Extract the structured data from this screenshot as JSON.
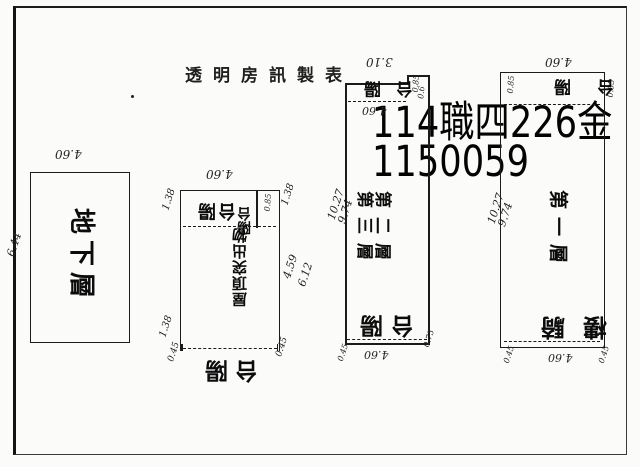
{
  "page": {
    "paper_color": "#fbfbf9",
    "ink_color": "#1b1b1b"
  },
  "header": {
    "title": "透明房訊製表"
  },
  "overlay": {
    "line1": "114職四226金",
    "line2": "1150059"
  },
  "plans": {
    "basement": {
      "label": "地下層",
      "dim_width": "4.60",
      "dim_height": "6.44"
    },
    "roof": {
      "dim_width": "4.60",
      "dim_corner_tl": "1.38",
      "dim_corner_tr": "1.38",
      "balcony_top": "陽台",
      "balcony_side": "陽台",
      "dim_inner": "0.85",
      "label": "屋頂突出物",
      "dim_side_a": "4.59",
      "dim_side_b": "6.12",
      "dim_corner_bl_a": "1.38",
      "dim_corner_bl_b": "0.45",
      "dim_corner_br": "0.45",
      "balcony_bottom": "陽台"
    },
    "floor23": {
      "dim_top": "3.10",
      "dim_step_a": "0.85",
      "dim_step_b": "0.6",
      "dim_width": "4.60",
      "balcony_top": "陽台",
      "label_floor3": "第三層",
      "label_floor2": "第二層",
      "dim_height_a": "10.27",
      "dim_height_b": "9.74",
      "balcony_bottom": "陽台",
      "dim_bottom": "4.60",
      "dim_corner_bl": "0.45",
      "dim_corner_br": "0.75"
    },
    "floor1": {
      "dim_width": "4.60",
      "dim_mark_left": "0.85",
      "dim_mark_right": "0.85",
      "balcony_top": "陽台",
      "label": "第一層",
      "dim_height_a": "10.27",
      "dim_height_b": "9.74",
      "arcade_label": "騎樓",
      "dim_bottom": "4.60",
      "dim_corner_bl": "0.45",
      "dim_corner_br": "0.45"
    }
  }
}
